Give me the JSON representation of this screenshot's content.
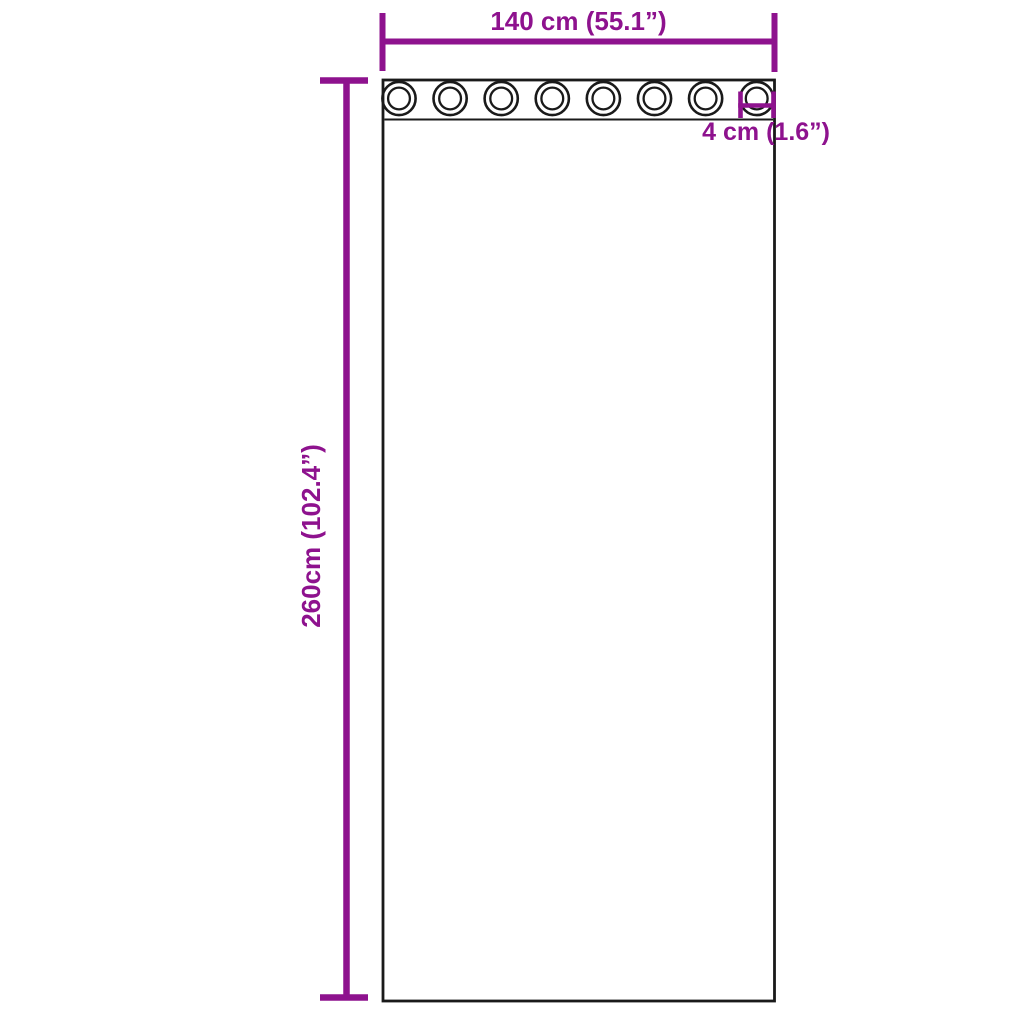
{
  "title": "Curtain with grommets dimension diagram",
  "colors": {
    "accent": "#8E128E",
    "outline": "#1A1A1A",
    "background": "#FFFFFF"
  },
  "dimensions": {
    "width_label": "140 cm (55.1”)",
    "height_label": "260cm (102.4”)",
    "grommet_label": "4 cm (1.6”)"
  },
  "diagram": {
    "grommet_count": 8
  }
}
